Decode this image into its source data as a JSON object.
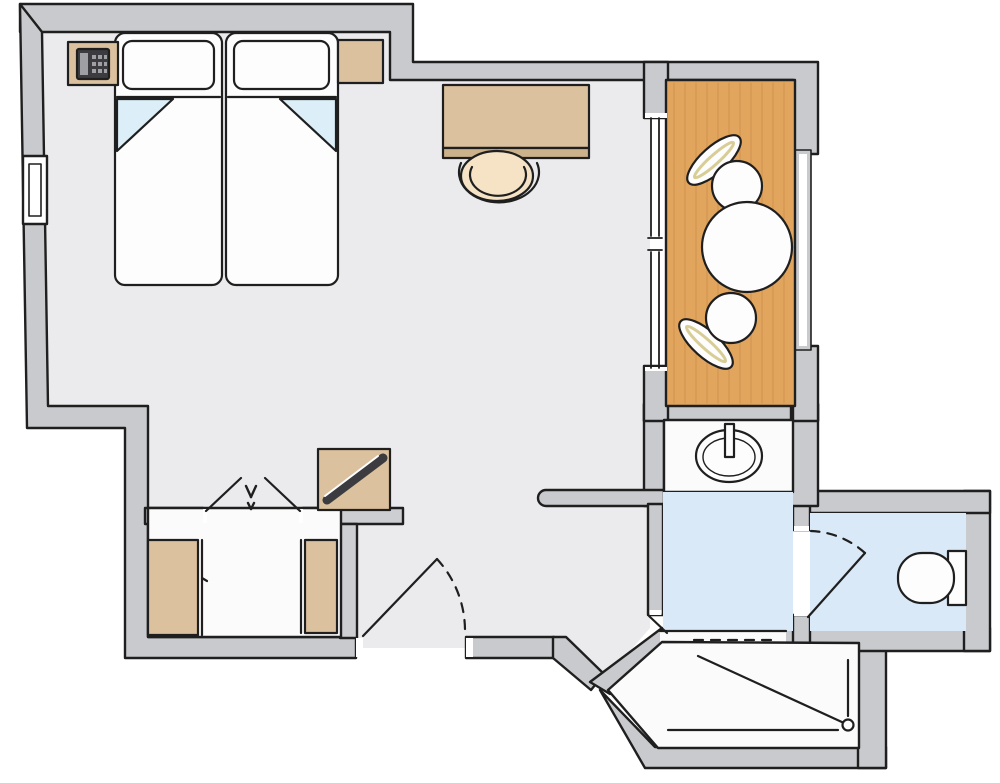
{
  "diagram": {
    "type": "floor-plan",
    "subject": "hotel-room-top-down-plan",
    "rooms": [
      {
        "name": "bedroom-living-area",
        "floor_style": "light-gray",
        "furniture": [
          "twin-bed-left",
          "twin-bed-right",
          "nightstand-with-phone",
          "nightstand-right",
          "desk",
          "desk-chair",
          "luggage-rack"
        ]
      },
      {
        "name": "closet-nook",
        "floor_style": "white",
        "furniture": [
          "wardrobe-left",
          "wardrobe-right",
          "bifold-doors",
          "shelf-counter"
        ]
      },
      {
        "name": "balcony",
        "floor_style": "wood",
        "furniture": [
          "round-table",
          "balcony-chair-upper",
          "balcony-chair-lower"
        ],
        "features": [
          "sliding-glass-door",
          "railing"
        ]
      },
      {
        "name": "sink-alcove",
        "floor_style": "white",
        "fixtures": [
          "washbasin-with-tap"
        ]
      },
      {
        "name": "bathroom-vestibule",
        "floor_style": "light-blue",
        "features": [
          "opening-to-shower"
        ]
      },
      {
        "name": "wc-room",
        "floor_style": "light-blue",
        "fixtures": [
          "toilet-with-cistern"
        ],
        "features": [
          "swing-door"
        ]
      },
      {
        "name": "shower-room",
        "floor_style": "white",
        "fixtures": [
          "shower-tray",
          "floor-drain"
        ],
        "features": [
          "dashed-curtain-entrance"
        ]
      },
      {
        "name": "entry",
        "features": [
          "entrance-door-swing",
          "window-in-left-wall"
        ]
      }
    ],
    "colors": {
      "background": "#ffffff",
      "wall_fill": "#c9cacd",
      "outline": "#1f1f1f",
      "main_floor": "#ebebed",
      "white_floor": "#fbfbfc",
      "white_fixture": "#fdfdfd",
      "bathroom_floor": "#d9e9f7",
      "balcony_wood": "#e2a55e",
      "wood_grain": "#c68c48",
      "furniture_tan": "#dcc19e",
      "furniture_tan_dark": "#cbb28a",
      "chair_seat": "#f6e3c6",
      "chair_sliver": "#d9cd96",
      "blanket_fold": "#dceef7",
      "dark_accent": "#3c3c40",
      "phone_light": "#9fa0a4",
      "shelf_gray": "#cdced2"
    }
  }
}
